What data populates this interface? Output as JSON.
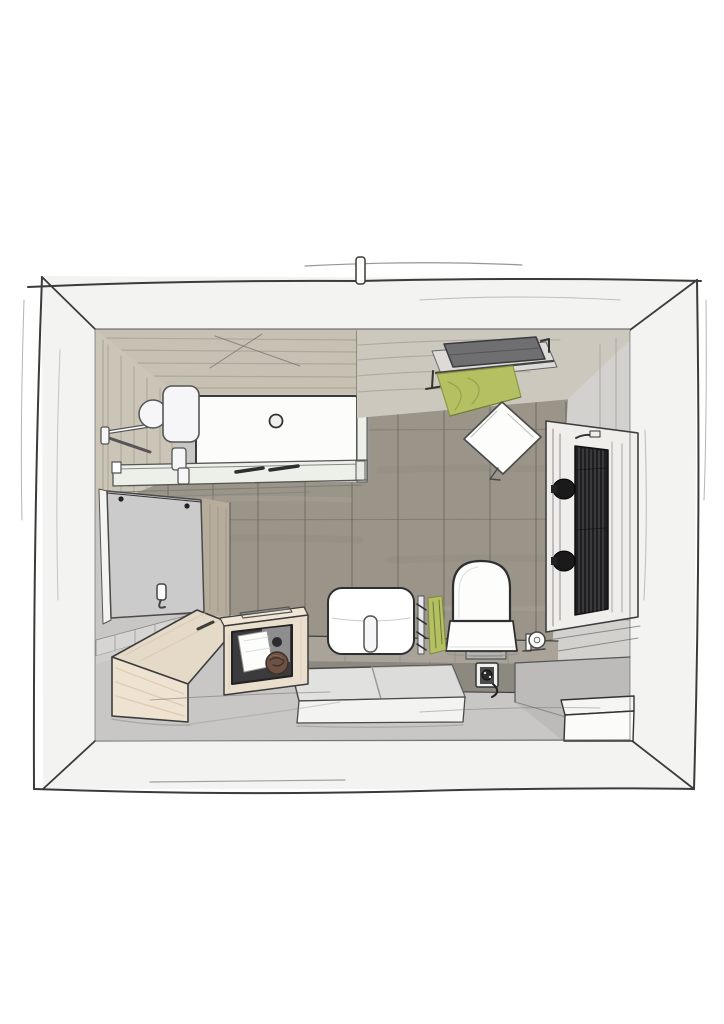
{
  "scene": {
    "description": "Hand-drawn bird's-eye sketch of a bathroom interior",
    "objects": [
      "outer wall frame",
      "shower tray with drain",
      "shower glass screen",
      "shower glass panel",
      "shower head fixture",
      "wood plank floor",
      "beige plank back wall",
      "slatted shower side wall",
      "towel shelf",
      "gray folded towel",
      "green hanging towel",
      "white towel on floor",
      "radiator niche",
      "dark radiator",
      "radiator knobs",
      "wall mirror",
      "robe hook",
      "wall tiles",
      "wood wall panel",
      "storage bench",
      "vanity cabinet",
      "white towel in cabinet",
      "rolled brown towel",
      "washbasin",
      "basin faucet",
      "towel rail",
      "green towel on rail",
      "toilet",
      "toilet paper holder",
      "floor drain grate",
      "power outlet with cord",
      "tiled counter ledge",
      "bath step with mats",
      "gray side platform",
      "white corner step box",
      "wall top tab"
    ]
  },
  "colors": {
    "page_background": "#ffffff",
    "wall_band": "#f3f3f1",
    "ink": "#3b3b3b",
    "top_wall_planks": "#c7c1b3",
    "top_right_wall": "#ccc8bd",
    "side_wall_planks": "#cbc5b7",
    "wall_wood_panel": "#b6ac9b",
    "shower_tray": "#fcfcfa",
    "glass": "#edf0e8",
    "floor_wood": "#9b9489",
    "floor_gray": "#c8c7c5",
    "tile_row": "#d6d5d3",
    "counter_top": "#aaa399",
    "counter_front": "#8d8981",
    "platform_gray": "#bcbbb9",
    "mat_top": "#e1e1e0",
    "mat_front": "#f3f3f2",
    "bench_top": "#e5dac7",
    "bench_front": "#eee2d0",
    "cabinet_wood": "#eadfcd",
    "cabinet_top": "#f1e6d6",
    "compartment": "#3b3b3d",
    "inner_panel_gray": "#8e8e8e",
    "towel_white": "#fdfdfc",
    "towel_gray": "#6f6f72",
    "towel_green": "#b5c063",
    "towel_roll_brown": "#6d5144",
    "mirror_gray": "#cbcbcb",
    "mirror_frame": "#f4f4f3",
    "right_wall": "#d2d1ce",
    "niche_frame": "#efeeea",
    "radiator_dark": "#1f1f21",
    "fixture_white": "#f6f6f8",
    "shelf_gray": "#dcdbd8",
    "white_box": "#fbfbfa",
    "grate_gray": "#b6b5b2",
    "outlet_plate": "#f0f0ee",
    "outlet_inner": "#4a4a4c",
    "knob_black": "#1a1a1a"
  }
}
